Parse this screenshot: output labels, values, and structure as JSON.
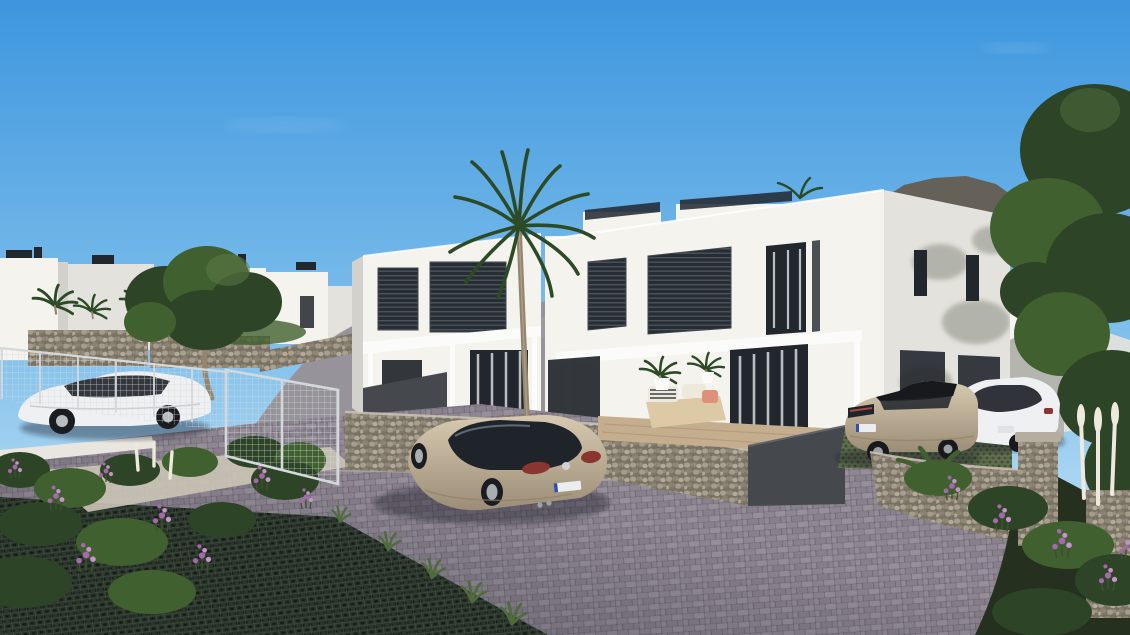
{
  "scene": {
    "description": "3D architectural rendering of a modern development of white two-storey villas on a sloping cobblestone street under a clear blue sky. A champagne-coloured sedan drives on the paved road in the centre; a champagne SUV with a black roof and a white coupe are parked on a grass-paver driveway beside the main villa; a white hatchback sits behind a wire-mesh fence on the left. Tall palm and leafy trees, gabion stone walls, purple flowering shrubs and white pampas grass frame the street; the bottom-left lawn grid lies in shadow.",
    "time_of_day": "clear sunny day",
    "license_plates": "present but illegible",
    "visible_text": "none"
  },
  "objects": {
    "main_villa": "two-storey white villa with dark louvered windows, white pergola and wooden terrace deck",
    "left_villa": "second white villa with louvered shutters behind a tall palm",
    "background_homes": "row of distant white houses with rooftop vents along uphill road",
    "center_car": "champagne sedan seen from rear three-quarter above",
    "suv": "champagne SUV with black roof parked on driveway",
    "coupe": "white coupe parked behind the SUV",
    "left_car": "white hatchback behind wire-mesh fence",
    "walls": "gabion wire-cage stone retaining walls and pillars",
    "road": "grey-mauve cobblestone pavers with shadowed grass-grid parking at lower left"
  },
  "colors": {
    "sky_top": "#3d96de",
    "sky_mid": "#82c1ec",
    "sky_horizon": "#d7ecf8",
    "wall_white": "#f5f3ee",
    "wall_shade": "#e4e2dd",
    "wall_dark": "#d3d1cc",
    "window_dark": "#22272d",
    "pergola": "#fbfbf9",
    "deck": "#c5ae8e",
    "sofa": "#dccaa6",
    "cushion": "#e08f7a",
    "road_tint": "#8e8692",
    "road_distant": "#96949a",
    "driveway_green": "#5c6b49",
    "gabion_base": "#9d9484",
    "foliage_dark": "#2d4426",
    "foliage_mid": "#416030",
    "foliage_light": "#5b7a45",
    "palm": "#2c4a25",
    "trunk": "#93856e",
    "flower_purple": "#a469ab",
    "flower_pink": "#c795cb",
    "pampas": "#eee9dd",
    "fence_wire": "#d5d8da",
    "fence_panel": "#45494e",
    "car_champagne": "#c0b096",
    "car_champagne_dark": "#97886f",
    "car_white": "#eef0f1",
    "glass": "#1f242a",
    "tail_red": "#8a3530",
    "plate_blue": "#2c50b0",
    "plate_white": "#eaeef1",
    "rock": "#655a4c",
    "kerb": "#e9e6df",
    "path_stone": "#cbc4b6",
    "grass_dark": "#25301f",
    "shadow": "rgba(18,22,38,0.40)"
  }
}
